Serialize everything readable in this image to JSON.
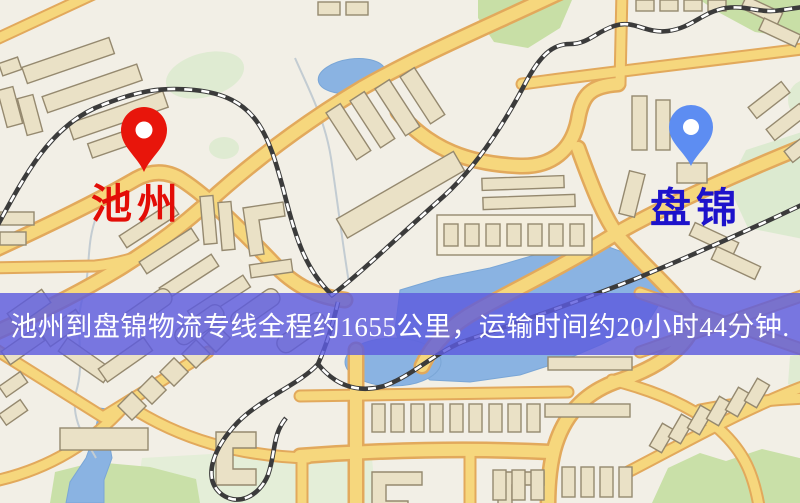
{
  "map": {
    "origin": {
      "name": "池州",
      "pin_color": "#e8150b",
      "label_color": "#e30d07"
    },
    "destination": {
      "name": "盘锦",
      "pin_color": "#5d8df2",
      "label_color": "#1d12cb"
    }
  },
  "banner": {
    "text": "池州到盘锦物流专线全程约1655公里，运输时间约20小时44分钟.",
    "background_color": "#5d5cde",
    "text_color": "#ffffff"
  },
  "route": {
    "distance_km": "1655",
    "duration": "20小时44分钟"
  },
  "map_colors": {
    "background": "#f2efe6",
    "road_fill": "#f6d77d",
    "road_casing": "#e2a95c",
    "building": "#eae1c6",
    "green_area": "#c9e0a8",
    "water": "#8ab3e2",
    "railway": "#3b3b3b"
  }
}
